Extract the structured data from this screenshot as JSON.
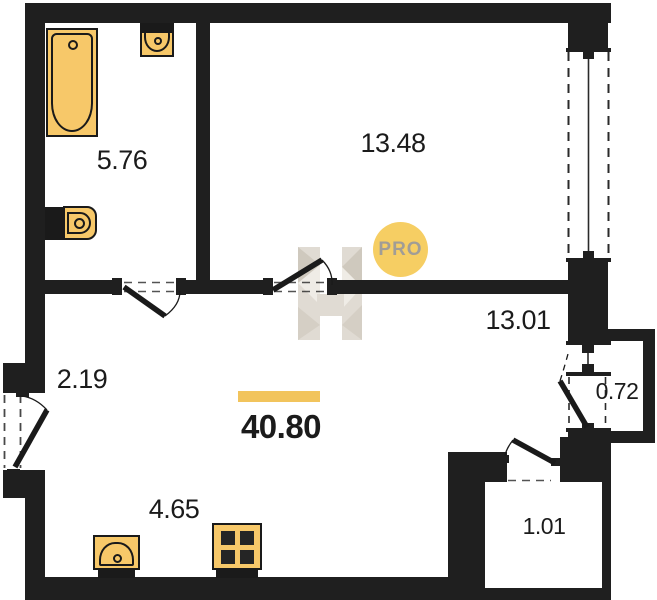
{
  "title": "apartment-floor-plan",
  "total": {
    "area": "40.80"
  },
  "rooms": [
    {
      "id": "bathroom",
      "area": "5.76"
    },
    {
      "id": "bedroom",
      "area": "13.48"
    },
    {
      "id": "living-room",
      "area": "13.01"
    },
    {
      "id": "hallway",
      "area": "2.19"
    },
    {
      "id": "kitchen",
      "area": "4.65"
    },
    {
      "id": "balcony",
      "area": "0.72"
    },
    {
      "id": "storage",
      "area": "1.01"
    }
  ],
  "watermark": {
    "badge": "PRO"
  },
  "colors": {
    "wall": "#1f1f1f",
    "fixture_fill": "#F7C869",
    "fixture_border": "#1a1a1a",
    "accent_bar": "#F2C45C",
    "badge_fill": "#F6CE63",
    "badge_text": "#A19D96",
    "watermark_bar": "#E0DBD3",
    "label_text": "#1b1b1b"
  }
}
